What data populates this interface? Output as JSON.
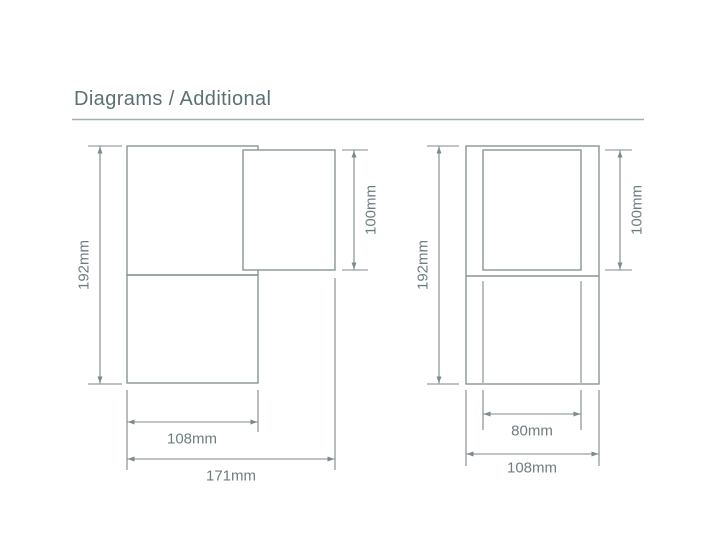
{
  "header": {
    "title": "Diagrams / Additional"
  },
  "colors": {
    "bg": "#ffffff",
    "outline": "#8a9495",
    "dim": "#7d898b",
    "label": "#6f7d7f",
    "title": "#5c7073",
    "rule": "#a5afaf"
  },
  "diagrams": {
    "left": {
      "labels": {
        "overall_height": "192mm",
        "top_box_height": "100mm",
        "body_width": "108mm",
        "overall_width": "171mm"
      }
    },
    "right": {
      "labels": {
        "overall_height": "192mm",
        "top_box_height": "100mm",
        "inner_width": "80mm",
        "overall_width": "108mm"
      }
    }
  }
}
